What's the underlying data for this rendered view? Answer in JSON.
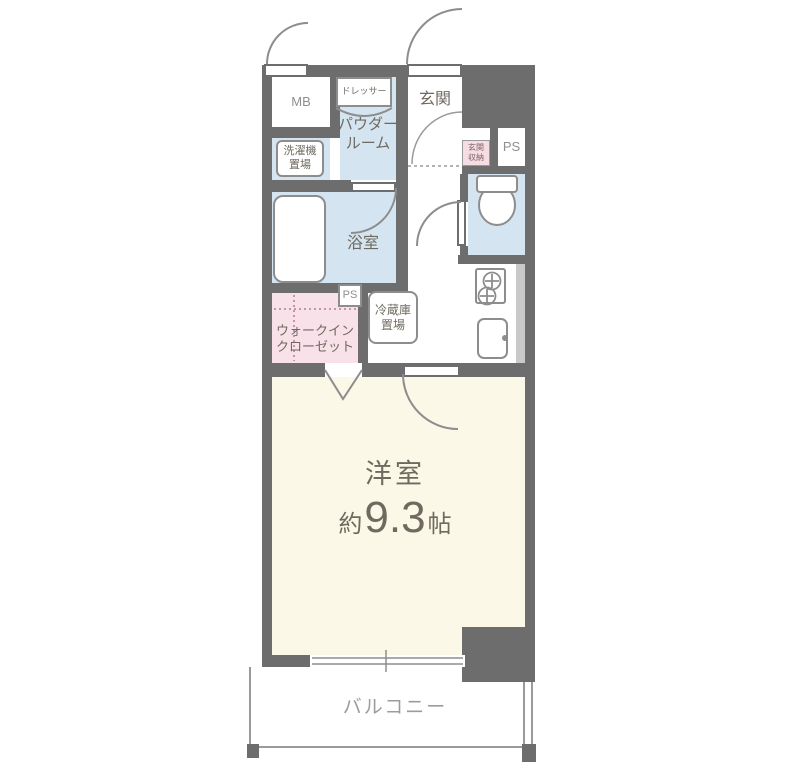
{
  "floorplan": {
    "type": "apartment-floor-plan",
    "rooms": {
      "meter_box": "MB",
      "dresser": "ドレッサー",
      "entrance": "玄関",
      "powder_room_line1": "パウダー",
      "powder_room_line2": "ルーム",
      "washer_space_line1": "洗濯機",
      "washer_space_line2": "置場",
      "bathroom": "浴室",
      "pipe_space_top": "PS",
      "pipe_space_mid": "PS",
      "entrance_storage_line1": "玄関",
      "entrance_storage_line2": "収納",
      "fridge_space_line1": "冷蔵庫",
      "fridge_space_line2": "置場",
      "walk_in_closet_line1": "ウォークイン",
      "walk_in_closet_line2": "クローゼット",
      "main_room_name": "洋室",
      "main_room_size_prefix": "約",
      "main_room_size_value": "9.3",
      "main_room_size_unit": "帖",
      "balcony": "バルコニー"
    },
    "colors": {
      "wall": "#6d6d6d",
      "wet_area_floor": "#d4e5f1",
      "closet_floor": "#f8e1e8",
      "main_room_floor": "#fbf8e7",
      "kitchen_counter": "#c9c9c9",
      "thin_line": "#8d8d8d",
      "label_text": "#6f6a60",
      "light_label_text": "#8f8f8f",
      "storage_label_text": "#7c6067",
      "background": "#ffffff"
    }
  }
}
